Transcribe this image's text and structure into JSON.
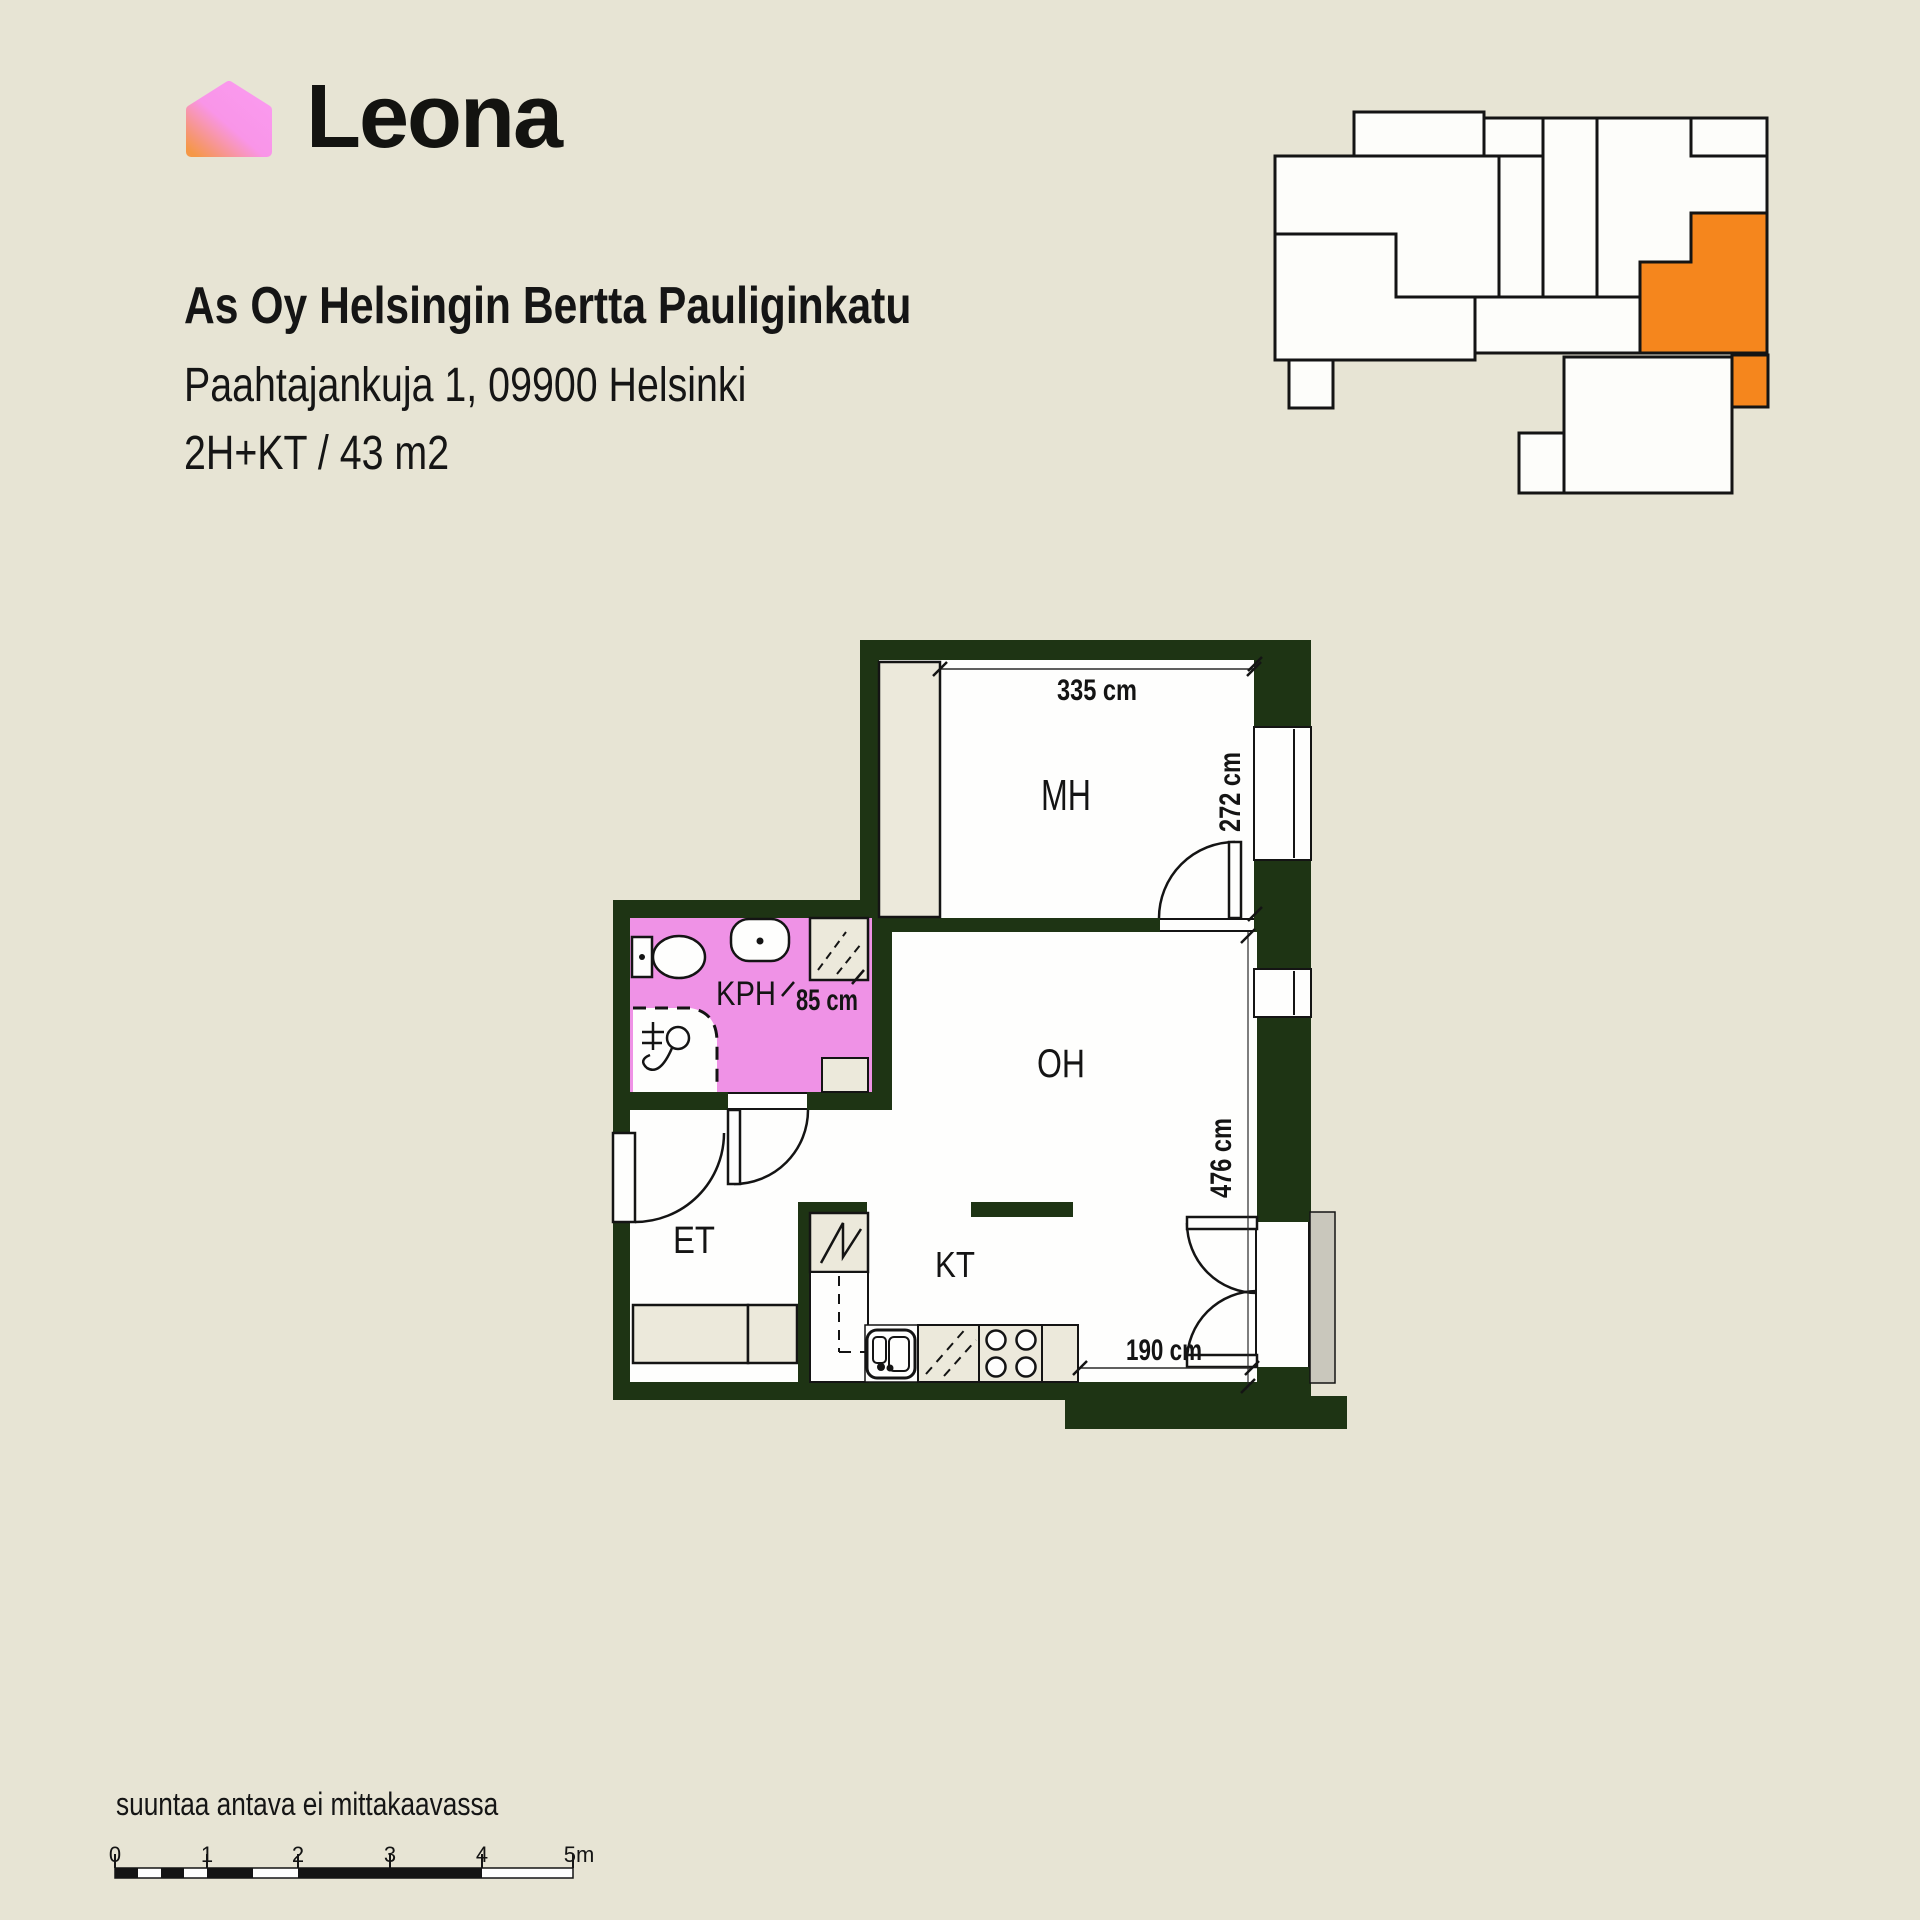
{
  "brand": {
    "name": "Leona"
  },
  "listing": {
    "housing_company": "As Oy Helsingin Bertta Pauliginkatu",
    "address": "Paahtajankuja 1, 09900 Helsinki",
    "layout": "2H+KT / 43 m2"
  },
  "site_plan": {
    "highlight_color": "#F5861D"
  },
  "floor_plan": {
    "wall_color": "#1E3414",
    "bathroom_color": "#EF92E6",
    "rooms": {
      "bedroom": "MH",
      "living_room": "OH",
      "bathroom": "KPH",
      "entrance": "ET",
      "kitchen": "KT"
    },
    "dimensions": {
      "bedroom_width": "335 cm",
      "bedroom_depth": "272 cm",
      "bathroom_door": "85 cm",
      "living_depth": "476 cm",
      "living_bottom": "190 cm"
    }
  },
  "footer": {
    "disclaimer": "suuntaa antava ei mittakaavassa",
    "scale_labels": [
      "0",
      "1",
      "2",
      "3",
      "4",
      "5m"
    ]
  }
}
